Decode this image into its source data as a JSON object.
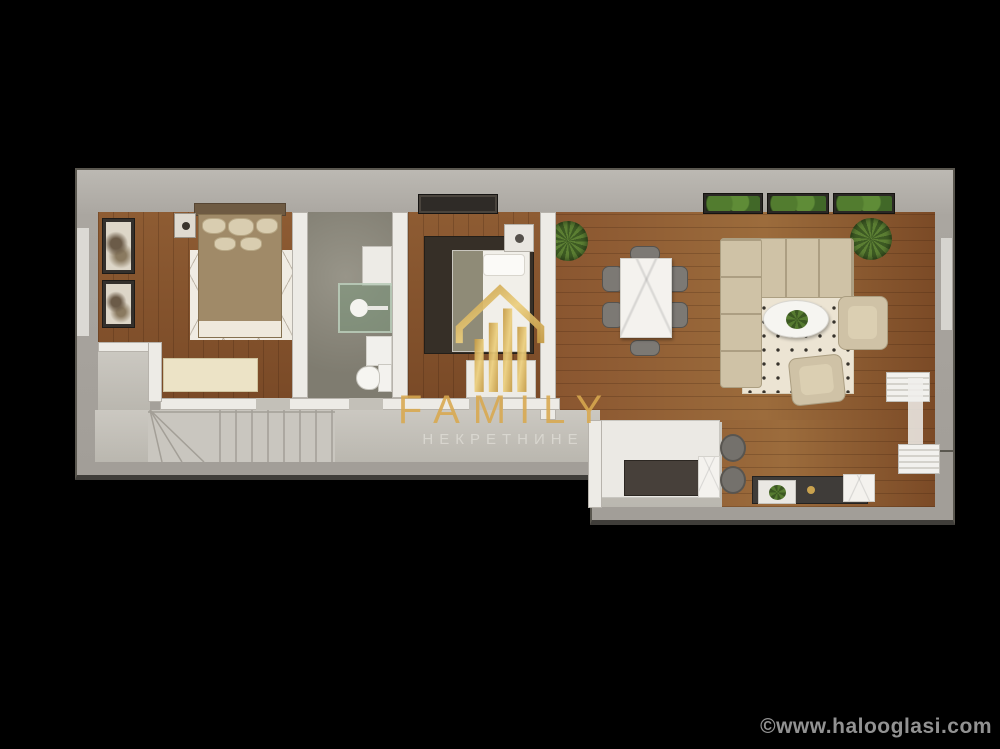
{
  "image": {
    "type": "3d-floor-plan-render",
    "background": "#000000"
  },
  "watermark": {
    "title": "FAMILY",
    "subtitle": "НЕКРЕТНИНЕ",
    "logo_icon": "gold-house-columns-icon",
    "accent_color": "#D9A94F"
  },
  "footer": {
    "copyright": "©www.halooglasi.com",
    "color": "#929292"
  },
  "floor_plan": {
    "rooms": [
      {
        "name": "bedroom-1",
        "floor": "wood",
        "furniture": [
          "double-bed",
          "line-pattern-rug",
          "wall-art",
          "wall-art",
          "nightstand",
          "dresser"
        ]
      },
      {
        "name": "bathroom",
        "floor": "concrete",
        "furniture": [
          "vanity",
          "glass-shower",
          "bath-mat",
          "toilet"
        ]
      },
      {
        "name": "bedroom-2",
        "floor": "wood",
        "furniture": [
          "single-bed",
          "dark-rug",
          "nightstand",
          "wardrobe",
          "dresser"
        ]
      },
      {
        "name": "hallway",
        "floor": "screed",
        "furniture": [
          "winder-staircase"
        ]
      },
      {
        "name": "living-dining-room",
        "floor": "wood",
        "furniture": [
          "sectional-sofa",
          "polka-dot-rug",
          "oval-coffee-table",
          "armchair",
          "armchair",
          "dining-table",
          "dining-chairs-x6",
          "tv-console",
          "radiator",
          "radiator",
          "potted-plant",
          "potted-plant",
          "window-planters-x3"
        ]
      },
      {
        "name": "kitchen",
        "floor": "screed",
        "furniture": [
          "counter",
          "dark-worktop",
          "bar-stools-x2"
        ]
      }
    ],
    "colors": {
      "wall": "#A8A49F",
      "wood_floor": "#8A5B33",
      "screed_floor": "#C6C3BC",
      "concrete_floor": "#8F8C80",
      "sofa_beige": "#CFC2A6",
      "shower_glass_green": "#7A967A"
    }
  }
}
